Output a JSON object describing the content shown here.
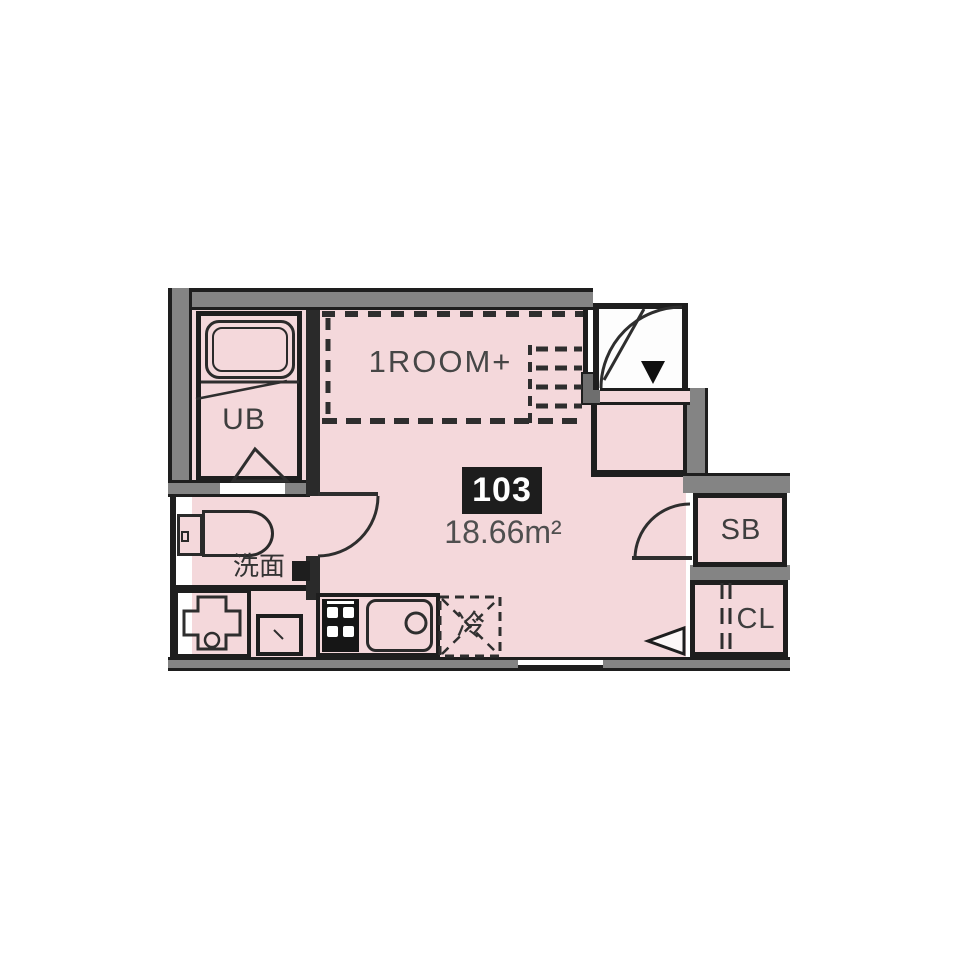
{
  "floorplan": {
    "room_label": "1ROOM+",
    "unit_number": "103",
    "area": "18.66m²",
    "labels": {
      "unit_bath": "UB",
      "washbasin": "洗面",
      "refrigerator": "冷",
      "shoe_box": "SB",
      "closet": "CL"
    },
    "icons": {
      "entrance_marker": "down-triangle",
      "loft_boundary": "dashed-line",
      "loft_ladder": "dashed-ladder",
      "refrigerator_space": "dashed-box-x",
      "closet_door": "folding-door-dashes",
      "door_swings": "quarter-arc"
    },
    "colors": {
      "floor": "#f4d8db",
      "wall": "#848484",
      "line": "#1e1e1e",
      "entrance_floor": "#fdfdfd",
      "unit_badge_bg": "#1d1d1d",
      "unit_badge_text": "#ffffff",
      "text": "#464646"
    }
  }
}
